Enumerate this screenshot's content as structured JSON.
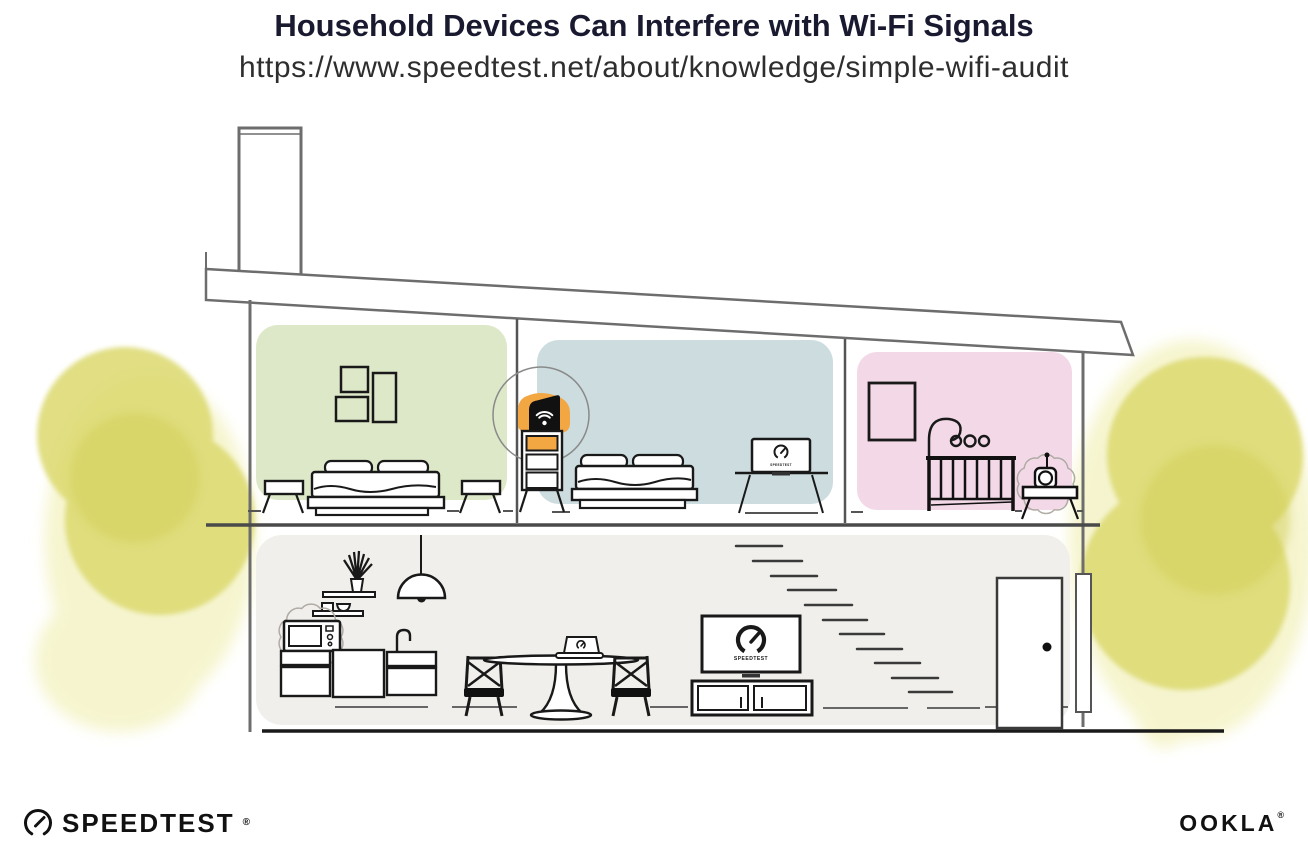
{
  "header": {
    "title": "Household Devices Can Interfere with Wi-Fi Signals",
    "url": "https://www.speedtest.net/about/knowledge/simple-wifi-audit"
  },
  "illustration": {
    "description": "Cutaway two-story house: upstairs a green bedroom, a blue bedroom with a Wi-Fi router highlighted on a shelf, and a pink nursery with a baby monitor; downstairs a kitchen with microwave, dining table with laptop, TV showing Speedtest, stairs and front door; yellow watercolor trees on both sides",
    "device_screen_label": "SPEEDTEST",
    "rooms": {
      "green_bedroom": "#dde8c9",
      "blue_bedroom": "#ccdcdf",
      "pink_nursery": "#f3d9e7",
      "downstairs": "#f0efeb"
    },
    "router_highlight": "#f2a743",
    "foliage": {
      "wash": "#edeb9f",
      "main": "#dcd96e",
      "shade": "#d2cf58"
    },
    "icons": {
      "router": "wifi-icon",
      "speedtest_logo": "speedometer-gauge-icon"
    },
    "interference_sources": [
      "microwave-oven",
      "baby-monitor"
    ]
  },
  "footer": {
    "speedtest_wordmark": "SPEEDTEST",
    "speedtest_trademark": "®",
    "ookla_wordmark": "OOKLA",
    "ookla_trademark": "®"
  }
}
